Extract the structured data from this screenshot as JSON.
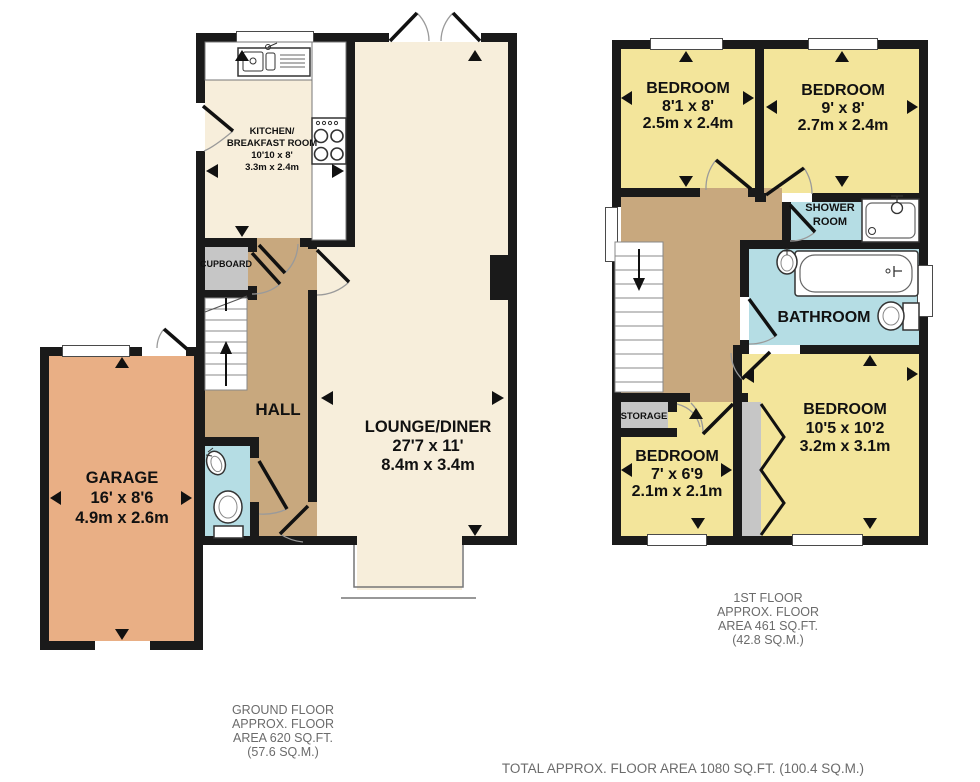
{
  "ground_floor": {
    "rooms": {
      "kitchen": {
        "name_line1": "KITCHEN/",
        "name_line2": "BREAKFAST ROOM",
        "dim_imperial": "10'10 x 8'",
        "dim_metric": "3.3m x 2.4m"
      },
      "cupboard": {
        "label": "CUPBOARD"
      },
      "hall": {
        "label": "HALL"
      },
      "lounge": {
        "label": "LOUNGE/DINER",
        "dim_imperial": "27'7 x 11'",
        "dim_metric": "8.4m x 3.4m"
      },
      "garage": {
        "label": "GARAGE",
        "dim_imperial": "16' x 8'6",
        "dim_metric": "4.9m x 2.6m"
      }
    },
    "caption": [
      "GROUND FLOOR",
      "APPROX. FLOOR",
      "AREA 620 SQ.FT.",
      "(57.6 SQ.M.)"
    ]
  },
  "first_floor": {
    "rooms": {
      "bedroom1": {
        "label": "BEDROOM",
        "dim_imperial": "8'1 x 8'",
        "dim_metric": "2.5m x 2.4m"
      },
      "bedroom2": {
        "label": "BEDROOM",
        "dim_imperial": "9' x 8'",
        "dim_metric": "2.7m x 2.4m"
      },
      "shower_room": {
        "line1": "SHOWER",
        "line2": "ROOM"
      },
      "bathroom": {
        "label": "BATHROOM"
      },
      "storage": {
        "label": "STORAGE"
      },
      "bedroom3": {
        "label": "BEDROOM",
        "dim_imperial": "7' x 6'9",
        "dim_metric": "2.1m x 2.1m"
      },
      "bedroom4": {
        "label": "BEDROOM",
        "dim_imperial": "10'5 x 10'2",
        "dim_metric": "3.2m x 3.1m"
      }
    },
    "caption": [
      "1ST FLOOR",
      "APPROX. FLOOR",
      "AREA 461 SQ.FT.",
      "(42.8 SQ.M.)"
    ]
  },
  "footer": {
    "total": "TOTAL APPROX. FLOOR AREA 1080 SQ.FT. (100.4 SQ.M.)"
  },
  "icons": [
    "measure-arrow-icon",
    "stairs-up-arrow-icon",
    "stairs-down-arrow-icon",
    "toilet-icon",
    "sink-icon",
    "bathtub-icon",
    "shower-tray-icon",
    "hob-icon",
    "kitchen-sink-icon",
    "door-swing-icon",
    "bifold-door-icon"
  ],
  "colors": {
    "wall": "#1a1a1a",
    "floor_cream": "#f7eedb",
    "floor_tan": "#c8a87e",
    "floor_garage": "#e9af85",
    "floor_bedroom": "#f3e59b",
    "floor_wet": "#b5dde4",
    "storage_gray": "#c6c6c6",
    "caption_gray": "#6b6b6b"
  }
}
